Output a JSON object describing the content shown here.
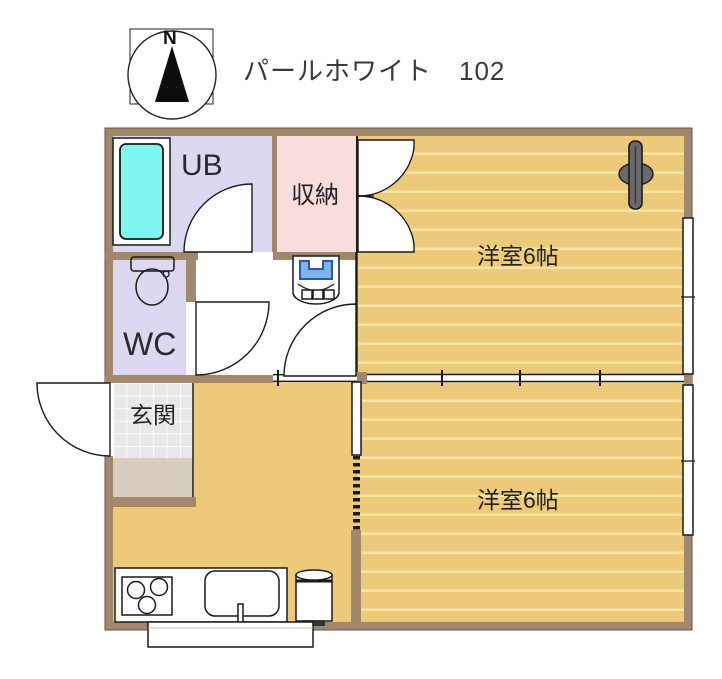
{
  "title": "パールホワイト　102",
  "compass": {
    "north_label": "N"
  },
  "rooms": {
    "unit_bath": "UB",
    "closet": "収納",
    "western_room_top": "洋室6帖",
    "wc": "WC",
    "entrance": "玄関",
    "western_room_bottom": "洋室6帖"
  },
  "icons": [
    "compass-icon",
    "bathtub-icon",
    "toilet-icon",
    "washbasin-icon",
    "ac-unit-icon",
    "stove-icon",
    "sink-icon",
    "faucet-icon",
    "water-heater-icon",
    "kitchen-counter",
    "porch-step",
    "entrance-door-arc",
    "ub-door-arc",
    "wc-door-arc",
    "kitchen-door-arc",
    "closet-double-doors",
    "sliding-door",
    "room-partition",
    "window-right-top",
    "window-right-bottom"
  ],
  "colors": {
    "wall": "#a1876b",
    "wall_edge": "#6b563f",
    "wood": "#ecca7a",
    "wood_stripe": "#f6e4a6",
    "lavender": "#dcd8f2",
    "pink": "#f9dcdc",
    "tile": "#e8e8e8",
    "step": "#d7cec0",
    "bathtub": "#7ef5ef",
    "basin_blue": "#7db4ea",
    "basin_blue_edge": "#2b55a8",
    "ac_gray": "#6a6a6a",
    "outline": "#1a1a1a",
    "text": "#3a3a3a"
  }
}
